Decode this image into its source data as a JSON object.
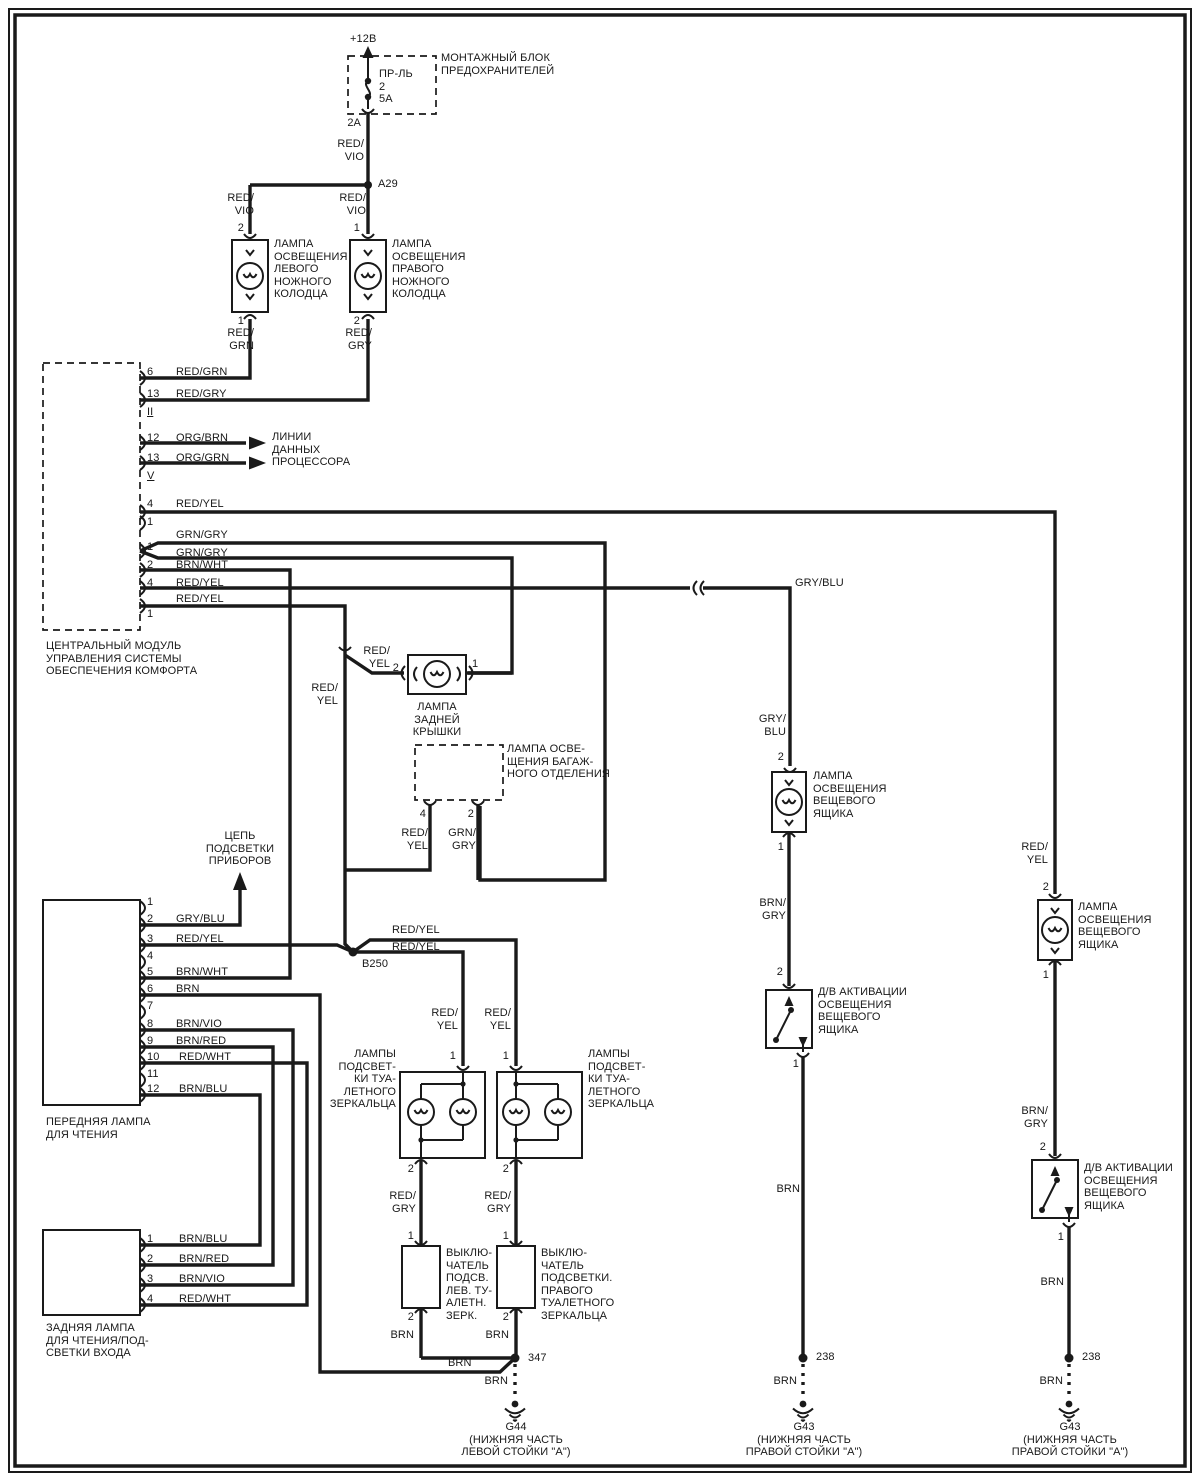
{
  "diagram": {
    "ink": "#1a1a1a",
    "background": "#ffffff",
    "labels": [
      {
        "name": "supply-voltage",
        "text": "+12В",
        "x": 350,
        "y": 33
      },
      {
        "name": "fuse-box-title",
        "text": "МОНТАЖНЫЙ БЛОК\nПРЕДОХРАНИТЕЛЕЙ",
        "x": 441,
        "y": 52
      },
      {
        "name": "fuse-name",
        "text": "ПР-ЛЬ\n2\n5А",
        "x": 379,
        "y": 68
      },
      {
        "name": "fuse-pin",
        "text": "2A",
        "x": 361,
        "y": 117,
        "anchor": "end"
      },
      {
        "name": "wire-red-vio-top",
        "text": "RED/\nVIO",
        "x": 364,
        "y": 138,
        "anchor": "end"
      },
      {
        "name": "splice-a29",
        "text": "A29",
        "x": 378,
        "y": 178
      },
      {
        "name": "wire-red-vio-left",
        "text": "RED/\nVIO",
        "x": 254,
        "y": 192,
        "anchor": "end"
      },
      {
        "name": "wire-red-vio-right",
        "text": "RED/\nVIO",
        "x": 366,
        "y": 192,
        "anchor": "end"
      },
      {
        "name": "pin-left-lamp-top",
        "text": "2",
        "x": 244,
        "y": 222,
        "anchor": "end"
      },
      {
        "name": "pin-right-lamp-top",
        "text": "1",
        "x": 360,
        "y": 222,
        "anchor": "end"
      },
      {
        "name": "left-footwell-lamp-label",
        "text": "ЛАМПА\nОСВЕЩЕНИЯ\nЛЕВОГО\nНОЖНОГО\nКОЛОДЦА",
        "x": 274,
        "y": 238
      },
      {
        "name": "right-footwell-lamp-label",
        "text": "ЛАМПА\nОСВЕЩЕНИЯ\nПРАВОГО\nНОЖНОГО\nКОЛОДЦА",
        "x": 392,
        "y": 238
      },
      {
        "name": "pin-left-lamp-bottom",
        "text": "1",
        "x": 244,
        "y": 315,
        "anchor": "end"
      },
      {
        "name": "pin-right-lamp-bottom",
        "text": "2",
        "x": 360,
        "y": 315,
        "anchor": "end"
      },
      {
        "name": "wire-red-grn",
        "text": "RED/\nGRN",
        "x": 254,
        "y": 327,
        "anchor": "end"
      },
      {
        "name": "wire-red-gry-lamp",
        "text": "RED/\nGRY",
        "x": 372,
        "y": 327,
        "anchor": "end"
      },
      {
        "name": "module-pin-6",
        "text": "6",
        "x": 147,
        "y": 366
      },
      {
        "name": "wire-red-grn-mod",
        "text": "RED/GRN",
        "x": 176,
        "y": 366
      },
      {
        "name": "module-pin-13a",
        "text": "13",
        "x": 147,
        "y": 388
      },
      {
        "name": "wire-red-gry-mod",
        "text": "RED/GRY",
        "x": 176,
        "y": 388
      },
      {
        "name": "module-conn-ii",
        "text": "II",
        "x": 147,
        "y": 406,
        "underline": true
      },
      {
        "name": "module-pin-12",
        "text": "12",
        "x": 147,
        "y": 432
      },
      {
        "name": "wire-org-brn",
        "text": "ORG/BRN",
        "x": 176,
        "y": 432
      },
      {
        "name": "module-pin-13b",
        "text": "13",
        "x": 147,
        "y": 452
      },
      {
        "name": "wire-org-grn",
        "text": "ORG/GRN",
        "x": 176,
        "y": 452
      },
      {
        "name": "module-conn-v",
        "text": "V",
        "x": 147,
        "y": 470,
        "underline": true
      },
      {
        "name": "processor-data-lines-label",
        "text": "ЛИНИИ\nДАННЫХ\nПРОЦЕССОРА",
        "x": 272,
        "y": 431
      },
      {
        "name": "module-pin-4a",
        "text": "4",
        "x": 147,
        "y": 498
      },
      {
        "name": "wire-red-yel-4a",
        "text": "RED/YEL",
        "x": 176,
        "y": 498
      },
      {
        "name": "module-pin-1a",
        "text": "1",
        "x": 147,
        "y": 516
      },
      {
        "name": "wire-grn-gry-1",
        "text": "GRN/GRY",
        "x": 176,
        "y": 529
      },
      {
        "name": "module-pin-1b",
        "text": "1",
        "x": 147,
        "y": 541
      },
      {
        "name": "wire-grn-gry-2",
        "text": "GRN/GRY",
        "x": 176,
        "y": 547
      },
      {
        "name": "module-pin-2b",
        "text": "2",
        "x": 147,
        "y": 559
      },
      {
        "name": "wire-brn-wht-mod",
        "text": "BRN/WHT",
        "x": 176,
        "y": 559
      },
      {
        "name": "module-pin-4b",
        "text": "4",
        "x": 147,
        "y": 577
      },
      {
        "name": "wire-red-yel-4b",
        "text": "RED/YEL",
        "x": 176,
        "y": 577
      },
      {
        "name": "wire-gry-blu",
        "text": "GRY/BLU",
        "x": 795,
        "y": 577
      },
      {
        "name": "module-pin-1c",
        "text": "1",
        "x": 147,
        "y": 608
      },
      {
        "name": "wire-red-yel-1c",
        "text": "RED/YEL",
        "x": 176,
        "y": 593
      },
      {
        "name": "comfort-module-label",
        "text": "ЦЕНТРАЛЬНЫЙ МОДУЛЬ\nУПРАВЛЕНИЯ СИСТЕМЫ\nОБЕСПЕЧЕНИЯ КОМФОРТА",
        "x": 46,
        "y": 640
      },
      {
        "name": "wire-red-yel-tail",
        "text": "RED/\nYEL",
        "x": 390,
        "y": 645,
        "anchor": "end"
      },
      {
        "name": "pin-tail-lamp-2",
        "text": "2",
        "x": 399,
        "y": 662,
        "anchor": "end"
      },
      {
        "name": "pin-tail-lamp-1",
        "text": "1",
        "x": 472,
        "y": 658
      },
      {
        "name": "tail-lamp-label",
        "text": "ЛАМПА\nЗАДНЕЙ\nКРЫШКИ",
        "x": 437,
        "y": 701,
        "anchor": "middle"
      },
      {
        "name": "wire-red-yel-down",
        "text": "RED/\nYEL",
        "x": 338,
        "y": 682,
        "anchor": "end"
      },
      {
        "name": "trunk-lamp-label",
        "text": "ЛАМПА ОСВЕ-\nЩЕНИЯ БАГАЖ-\nНОГО ОТДЕЛЕНИЯ",
        "x": 507,
        "y": 743
      },
      {
        "name": "pin-trunk-4",
        "text": "4",
        "x": 426,
        "y": 808,
        "anchor": "end"
      },
      {
        "name": "pin-trunk-2",
        "text": "2",
        "x": 474,
        "y": 808,
        "anchor": "end"
      },
      {
        "name": "wire-red-yel-trunk",
        "text": "RED/\nYEL",
        "x": 428,
        "y": 827,
        "anchor": "end"
      },
      {
        "name": "wire-grn-gry-trunk",
        "text": "GRN/\nGRY",
        "x": 476,
        "y": 827,
        "anchor": "end"
      },
      {
        "name": "instrument-circuit-label",
        "text": "ЦЕПЬ\nПОДСВЕТКИ\nПРИБОРОВ",
        "x": 240,
        "y": 830,
        "anchor": "middle"
      },
      {
        "name": "front-lamp-pin-1",
        "text": "1",
        "x": 147,
        "y": 896
      },
      {
        "name": "front-lamp-pin-2",
        "text": "2",
        "x": 147,
        "y": 913
      },
      {
        "name": "wire-gry-blu-front",
        "text": "GRY/BLU",
        "x": 176,
        "y": 913
      },
      {
        "name": "front-lamp-pin-3",
        "text": "3",
        "x": 147,
        "y": 933
      },
      {
        "name": "wire-red-yel-front",
        "text": "RED/YEL",
        "x": 176,
        "y": 933
      },
      {
        "name": "front-lamp-pin-4",
        "text": "4",
        "x": 147,
        "y": 950
      },
      {
        "name": "front-lamp-pin-5",
        "text": "5",
        "x": 147,
        "y": 966
      },
      {
        "name": "wire-brn-wht-front",
        "text": "BRN/WHT",
        "x": 176,
        "y": 966
      },
      {
        "name": "front-lamp-pin-6",
        "text": "6",
        "x": 147,
        "y": 983
      },
      {
        "name": "wire-brn-front",
        "text": "BRN",
        "x": 176,
        "y": 983
      },
      {
        "name": "front-lamp-pin-7",
        "text": "7",
        "x": 147,
        "y": 1000
      },
      {
        "name": "front-lamp-pin-8",
        "text": "8",
        "x": 147,
        "y": 1018
      },
      {
        "name": "wire-brn-vio-front",
        "text": "BRN/VIO",
        "x": 176,
        "y": 1018
      },
      {
        "name": "front-lamp-pin-9",
        "text": "9",
        "x": 147,
        "y": 1035
      },
      {
        "name": "wire-brn-red-front",
        "text": "BRN/RED",
        "x": 176,
        "y": 1035
      },
      {
        "name": "front-lamp-pin-10",
        "text": "10",
        "x": 147,
        "y": 1051
      },
      {
        "name": "wire-red-wht-front",
        "text": "RED/WHT",
        "x": 179,
        "y": 1051
      },
      {
        "name": "front-lamp-pin-11",
        "text": "11",
        "x": 147,
        "y": 1068
      },
      {
        "name": "front-lamp-pin-12",
        "text": "12",
        "x": 147,
        "y": 1083
      },
      {
        "name": "wire-brn-blu-front",
        "text": "BRN/BLU",
        "x": 179,
        "y": 1083
      },
      {
        "name": "splice-b250",
        "text": "B250",
        "x": 362,
        "y": 958
      },
      {
        "name": "wire-red-yel-b1",
        "text": "RED/YEL",
        "x": 392,
        "y": 924
      },
      {
        "name": "wire-red-yel-b2",
        "text": "RED/YEL",
        "x": 392,
        "y": 941
      },
      {
        "name": "front-reading-lamp-label",
        "text": "ПЕРЕДНЯЯ ЛАМПА\nДЛЯ ЧТЕНИЯ",
        "x": 46,
        "y": 1116
      },
      {
        "name": "wire-red-yel-vanity-left",
        "text": "RED/\nYEL",
        "x": 458,
        "y": 1007,
        "anchor": "end"
      },
      {
        "name": "wire-red-yel-vanity-right",
        "text": "RED/\nYEL",
        "x": 511,
        "y": 1007,
        "anchor": "end"
      },
      {
        "name": "vanity-left-label",
        "text": "ЛАМПЫ\nПОДСВЕТ-\nКИ ТУА-\nЛЕТНОГО\nЗЕРКАЛЬЦА",
        "x": 396,
        "y": 1048,
        "anchor": "end"
      },
      {
        "name": "vanity-right-label",
        "text": "ЛАМПЫ\nПОДСВЕТ-\nКИ ТУА-\nЛЕТНОГО\nЗЕРКАЛЬЦА",
        "x": 588,
        "y": 1048
      },
      {
        "name": "vanity-left-pin-1",
        "text": "1",
        "x": 456,
        "y": 1050,
        "anchor": "end"
      },
      {
        "name": "vanity-right-pin-1",
        "text": "1",
        "x": 509,
        "y": 1050,
        "anchor": "end"
      },
      {
        "name": "vanity-left-pin-2",
        "text": "2",
        "x": 414,
        "y": 1163,
        "anchor": "end"
      },
      {
        "name": "vanity-right-pin-2",
        "text": "2",
        "x": 509,
        "y": 1163,
        "anchor": "end"
      },
      {
        "name": "wire-red-gry-left",
        "text": "RED/\nGRY",
        "x": 416,
        "y": 1190,
        "anchor": "end"
      },
      {
        "name": "wire-red-gry-right",
        "text": "RED/\nGRY",
        "x": 511,
        "y": 1190,
        "anchor": "end"
      },
      {
        "name": "switch-left-pin-1",
        "text": "1",
        "x": 414,
        "y": 1230,
        "anchor": "end"
      },
      {
        "name": "switch-right-pin-1",
        "text": "1",
        "x": 509,
        "y": 1230,
        "anchor": "end"
      },
      {
        "name": "left-mirror-switch-label",
        "text": "ВЫКЛЮ-\nЧАТЕЛЬ\nПОДСВ.\nЛЕВ. ТУ-\nАЛЕТН.\nЗЕРК.",
        "x": 446,
        "y": 1247
      },
      {
        "name": "right-mirror-switch-label",
        "text": "ВЫКЛЮ-\nЧАТЕЛЬ\nПОДСВЕТКИ.\nПРАВОГО\nТУАЛЕТНОГО\nЗЕРКАЛЬЦА",
        "x": 541,
        "y": 1247
      },
      {
        "name": "switch-left-pin-2",
        "text": "2",
        "x": 414,
        "y": 1311,
        "anchor": "end"
      },
      {
        "name": "switch-right-pin-2",
        "text": "2",
        "x": 509,
        "y": 1311,
        "anchor": "end"
      },
      {
        "name": "wire-brn-switch-left",
        "text": "BRN",
        "x": 414,
        "y": 1329,
        "anchor": "end"
      },
      {
        "name": "wire-brn-switch-right",
        "text": "BRN",
        "x": 509,
        "y": 1329,
        "anchor": "end"
      },
      {
        "name": "splice-347",
        "text": "347",
        "x": 528,
        "y": 1352
      },
      {
        "name": "wire-brn-feeder",
        "text": "BRN",
        "x": 448,
        "y": 1357
      },
      {
        "name": "wire-brn-g44",
        "text": "BRN",
        "x": 508,
        "y": 1375,
        "anchor": "end"
      },
      {
        "name": "ground-g44-label",
        "text": "G44\n(НИЖНЯЯ ЧАСТЬ\nЛЕВОЙ СТОЙКИ \"А\")",
        "x": 516,
        "y": 1421,
        "anchor": "middle"
      },
      {
        "name": "wire-gry-blu-mid",
        "text": "GRY/\nBLU",
        "x": 786,
        "y": 713,
        "anchor": "end"
      },
      {
        "name": "glovebox-lamp-1-pin-2",
        "text": "2",
        "x": 784,
        "y": 751,
        "anchor": "end"
      },
      {
        "name": "glovebox-lamp-1-label",
        "text": "ЛАМПА\nОСВЕЩЕНИЯ\nВЕЩЕВОГО\nЯЩИКА",
        "x": 813,
        "y": 770
      },
      {
        "name": "glovebox-lamp-1-pin-1",
        "text": "1",
        "x": 784,
        "y": 841,
        "anchor": "end"
      },
      {
        "name": "wire-brn-gry-mid",
        "text": "BRN/\nGRY",
        "x": 786,
        "y": 897,
        "anchor": "end"
      },
      {
        "name": "glovebox-switch-1-pin-2",
        "text": "2",
        "x": 783,
        "y": 966,
        "anchor": "end"
      },
      {
        "name": "glovebox-switch-1-label",
        "text": "Д/В АКТИВАЦИИ\nОСВЕЩЕНИЯ\nВЕЩЕВОГО\nЯЩИКА",
        "x": 818,
        "y": 986
      },
      {
        "name": "glovebox-switch-1-pin-1",
        "text": "1",
        "x": 799,
        "y": 1058,
        "anchor": "end"
      },
      {
        "name": "wire-brn-mid",
        "text": "BRN",
        "x": 800,
        "y": 1183,
        "anchor": "end"
      },
      {
        "name": "splice-238-mid",
        "text": "238",
        "x": 816,
        "y": 1351
      },
      {
        "name": "wire-brn-mid-gnd",
        "text": "BRN",
        "x": 797,
        "y": 1375,
        "anchor": "end"
      },
      {
        "name": "ground-g43-mid-label",
        "text": "G43\n(НИЖНЯЯ ЧАСТЬ\nПРАВОЙ СТОЙКИ \"А\")",
        "x": 804,
        "y": 1421,
        "anchor": "middle"
      },
      {
        "name": "wire-red-yel-rightcol",
        "text": "RED/\nYEL",
        "x": 1048,
        "y": 841,
        "anchor": "end"
      },
      {
        "name": "glovebox-lamp-2-pin-2",
        "text": "2",
        "x": 1049,
        "y": 881,
        "anchor": "end"
      },
      {
        "name": "glovebox-lamp-2-label",
        "text": "ЛАМПА\nОСВЕЩЕНИЯ\nВЕЩЕВОГО\nЯЩИКА",
        "x": 1078,
        "y": 901
      },
      {
        "name": "glovebox-lamp-2-pin-1",
        "text": "1",
        "x": 1049,
        "y": 969,
        "anchor": "end"
      },
      {
        "name": "wire-brn-gry-right",
        "text": "BRN/\nGRY",
        "x": 1048,
        "y": 1105,
        "anchor": "end"
      },
      {
        "name": "glovebox-switch-2-pin-2",
        "text": "2",
        "x": 1046,
        "y": 1141,
        "anchor": "end"
      },
      {
        "name": "glovebox-switch-2-label",
        "text": "Д/В АКТИВАЦИИ\nОСВЕЩЕНИЯ\nВЕЩЕВОГО\nЯЩИКА",
        "x": 1084,
        "y": 1162
      },
      {
        "name": "glovebox-switch-2-pin-1",
        "text": "1",
        "x": 1064,
        "y": 1231,
        "anchor": "end"
      },
      {
        "name": "wire-brn-right",
        "text": "BRN",
        "x": 1064,
        "y": 1276,
        "anchor": "end"
      },
      {
        "name": "splice-238-right",
        "text": "238",
        "x": 1082,
        "y": 1351
      },
      {
        "name": "wire-brn-right-gnd",
        "text": "BRN",
        "x": 1063,
        "y": 1375,
        "anchor": "end"
      },
      {
        "name": "ground-g43-right-label",
        "text": "G43\n(НИЖНЯЯ ЧАСТЬ\nПРАВОЙ СТОЙКИ \"А\")",
        "x": 1070,
        "y": 1421,
        "anchor": "middle"
      },
      {
        "name": "rear-lamp-pin-1",
        "text": "1",
        "x": 147,
        "y": 1233
      },
      {
        "name": "wire-brn-blu-rear",
        "text": "BRN/BLU",
        "x": 179,
        "y": 1233
      },
      {
        "name": "rear-lamp-pin-2",
        "text": "2",
        "x": 147,
        "y": 1253
      },
      {
        "name": "wire-brn-red-rear",
        "text": "BRN/RED",
        "x": 179,
        "y": 1253
      },
      {
        "name": "rear-lamp-pin-3",
        "text": "3",
        "x": 147,
        "y": 1273
      },
      {
        "name": "wire-brn-vio-rear",
        "text": "BRN/VIO",
        "x": 179,
        "y": 1273
      },
      {
        "name": "rear-lamp-pin-4",
        "text": "4",
        "x": 147,
        "y": 1293
      },
      {
        "name": "wire-red-wht-rear",
        "text": "RED/WHT",
        "x": 179,
        "y": 1293
      },
      {
        "name": "rear-reading-lamp-label",
        "text": "ЗАДНЯЯ ЛАМПА\nДЛЯ ЧТЕНИЯ/ПОД-\nСВЕТКИ ВХОДА",
        "x": 46,
        "y": 1322
      }
    ]
  }
}
